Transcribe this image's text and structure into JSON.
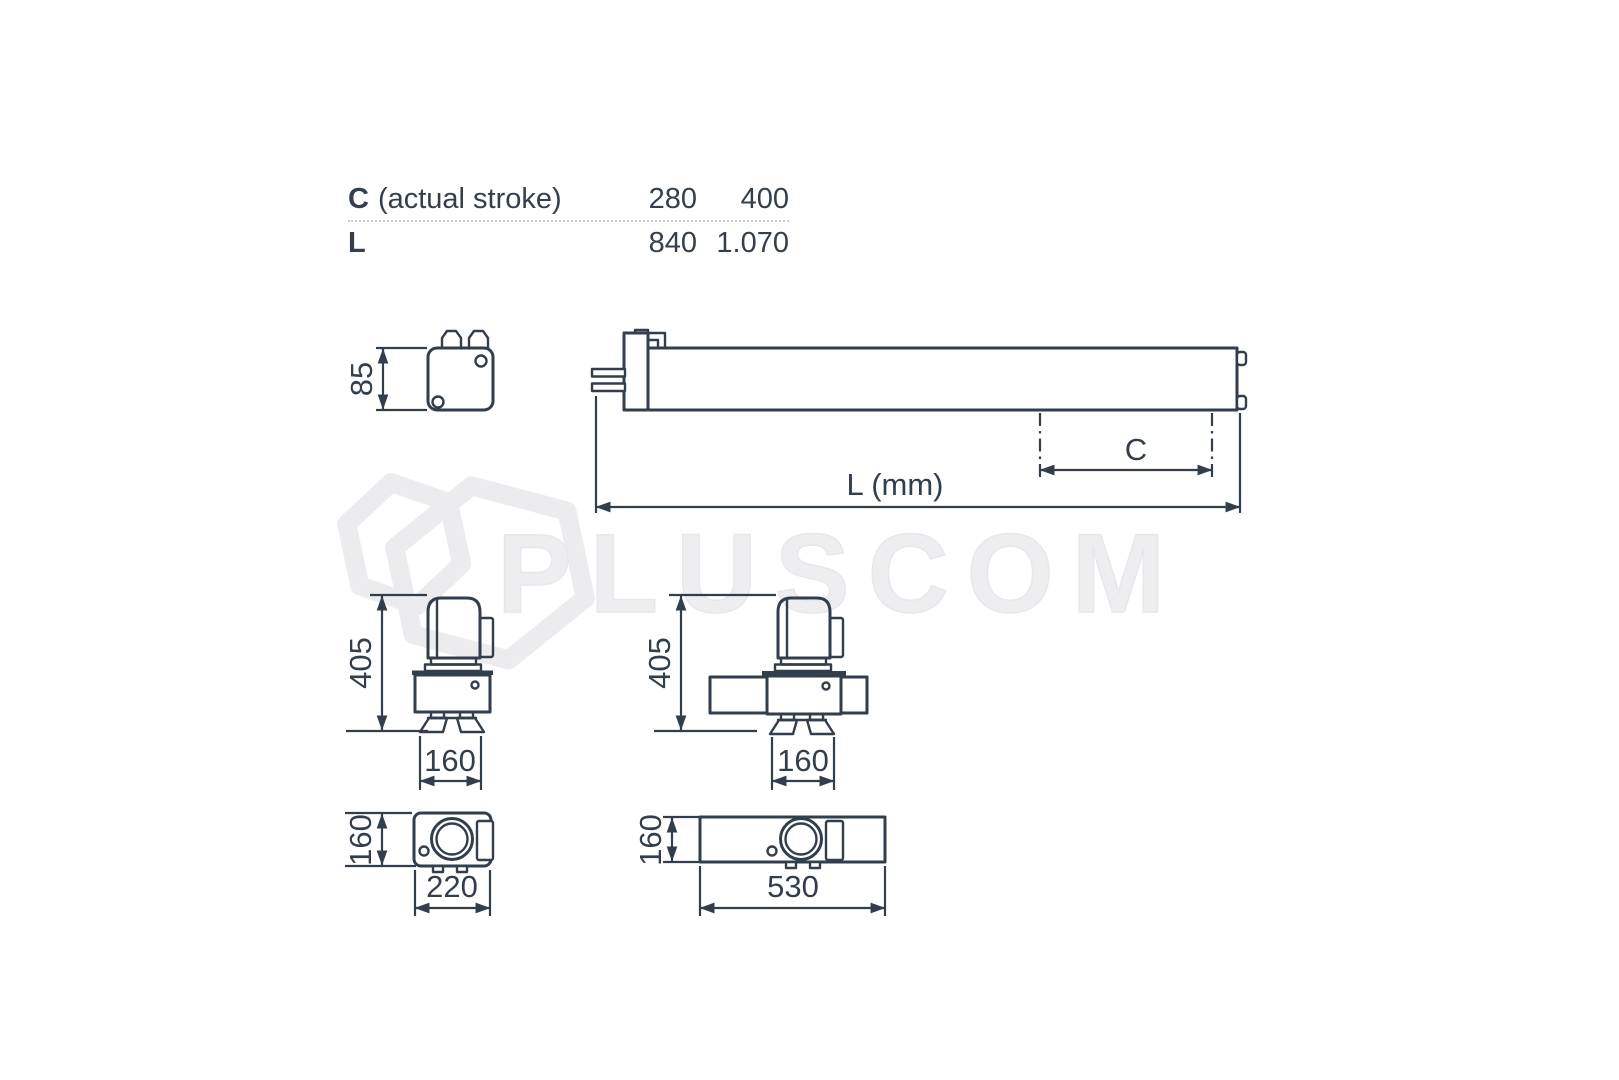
{
  "table": {
    "rows": [
      {
        "key": "C",
        "desc": "(actual stroke)",
        "values": [
          "280",
          "400"
        ]
      },
      {
        "key": "L",
        "desc": "",
        "values": [
          "840",
          "1.070"
        ]
      }
    ]
  },
  "watermark": {
    "text": "PLUSCOM"
  },
  "dimensions": {
    "end_view_height": "85",
    "overall_length": "L (mm)",
    "actual_stroke": "C",
    "side_left_height": "405",
    "side_left_foot_width": "160",
    "side_center_height": "405",
    "side_center_foot_width": "160",
    "top_left_depth": "160",
    "top_left_length": "220",
    "top_center_depth": "160",
    "top_center_length": "530"
  },
  "colors": {
    "ink": "#333e4c",
    "watermark": "#ededf0",
    "background": "#ffffff"
  }
}
